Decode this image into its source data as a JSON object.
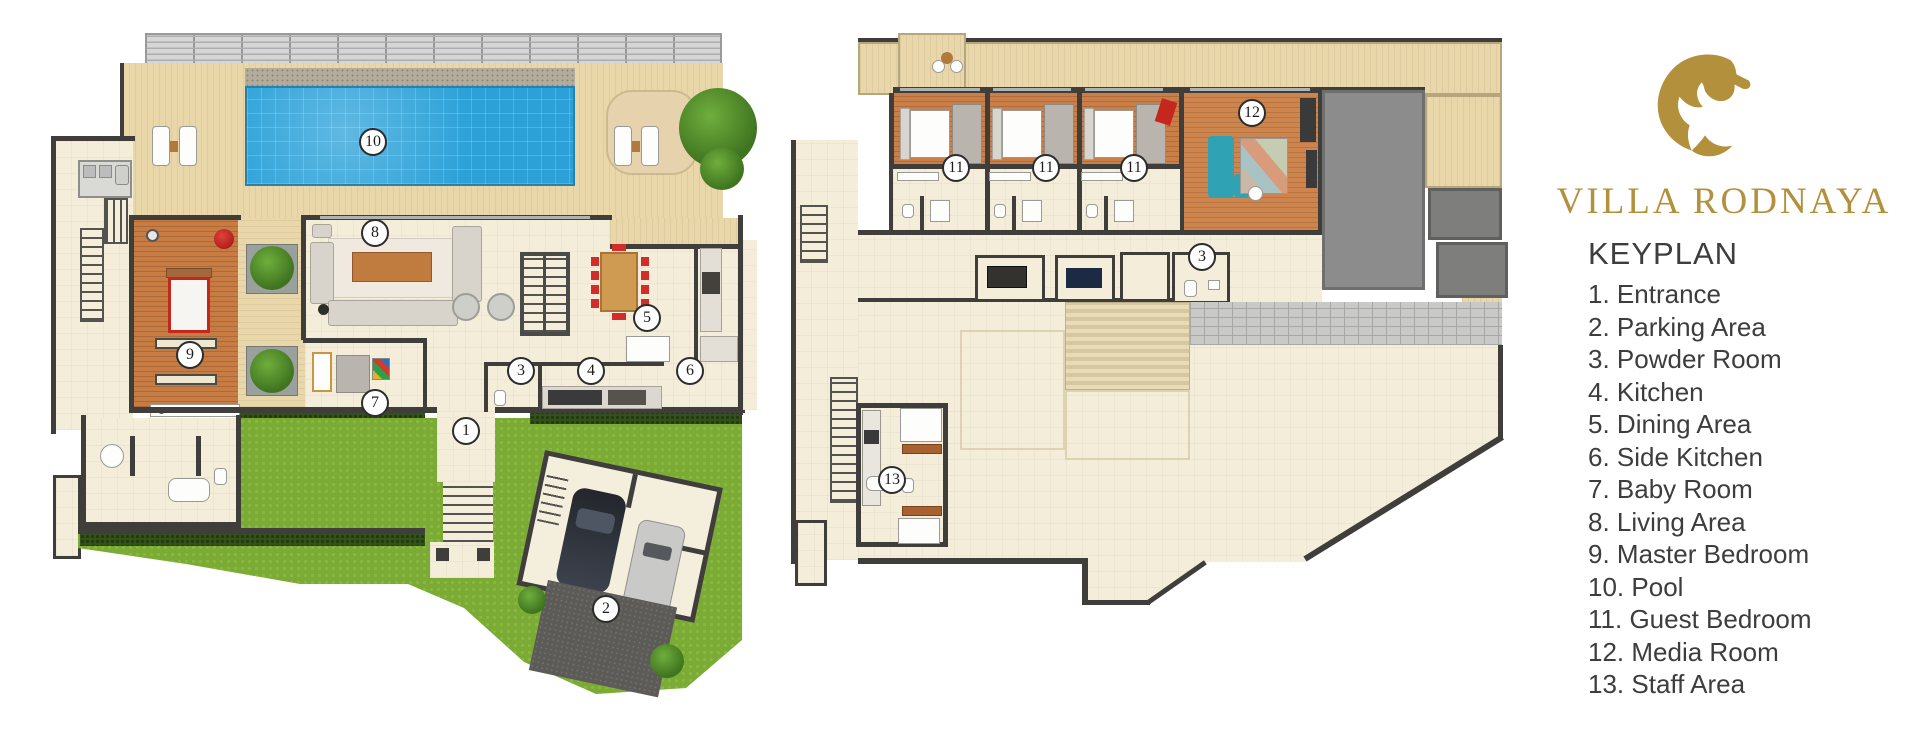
{
  "brand": {
    "title": "VILLA RODNAYA",
    "logo_icon": "gold-horse-head",
    "gold": "#b2903c"
  },
  "keyplan": {
    "heading": "KEYPLAN",
    "items": [
      {
        "num": "1.",
        "label": "Entrance"
      },
      {
        "num": "2.",
        "label": "Parking Area"
      },
      {
        "num": "3.",
        "label": "Powder Room"
      },
      {
        "num": "4.",
        "label": "Kitchen"
      },
      {
        "num": "5.",
        "label": "Dining Area"
      },
      {
        "num": "6.",
        "label": "Side Kitchen"
      },
      {
        "num": "7.",
        "label": "Baby Room"
      },
      {
        "num": "8.",
        "label": "Living Area"
      },
      {
        "num": "9.",
        "label": "Master Bedroom"
      },
      {
        "num": "10.",
        "label": "Pool"
      },
      {
        "num": "11.",
        "label": "Guest Bedroom"
      },
      {
        "num": "12.",
        "label": "Media Room"
      },
      {
        "num": "13.",
        "label": "Staff Area"
      }
    ]
  },
  "plans": {
    "ground": {
      "markers": [
        {
          "n": "1",
          "room": "Entrance"
        },
        {
          "n": "2",
          "room": "Parking Area"
        },
        {
          "n": "3",
          "room": "Powder Room"
        },
        {
          "n": "4",
          "room": "Kitchen"
        },
        {
          "n": "5",
          "room": "Dining Area"
        },
        {
          "n": "6",
          "room": "Side Kitchen"
        },
        {
          "n": "7",
          "room": "Baby Room"
        },
        {
          "n": "8",
          "room": "Living Area"
        },
        {
          "n": "9",
          "room": "Master Bedroom"
        },
        {
          "n": "10",
          "room": "Pool"
        }
      ]
    },
    "upper": {
      "markers": [
        {
          "n": "11",
          "room": "Guest Bedroom"
        },
        {
          "n": "11",
          "room": "Guest Bedroom"
        },
        {
          "n": "11",
          "room": "Guest Bedroom"
        },
        {
          "n": "12",
          "room": "Media Room"
        },
        {
          "n": "3",
          "room": "Powder Room"
        },
        {
          "n": "13",
          "room": "Staff Area"
        }
      ]
    }
  },
  "colors": {
    "pool_blue": "#2ba1d8",
    "grass_green": "#7cab35",
    "deck_tan": "#e9d7aa",
    "wood_orange": "#c67c43",
    "floor_cream": "#f3edd9",
    "wall_dark": "#3f3e3b",
    "roof_gray": "#8c8c8c",
    "accent_red": "#d42b2b",
    "sofa_teal": "#2fa3b4",
    "text_dark": "#3d3d3d"
  }
}
